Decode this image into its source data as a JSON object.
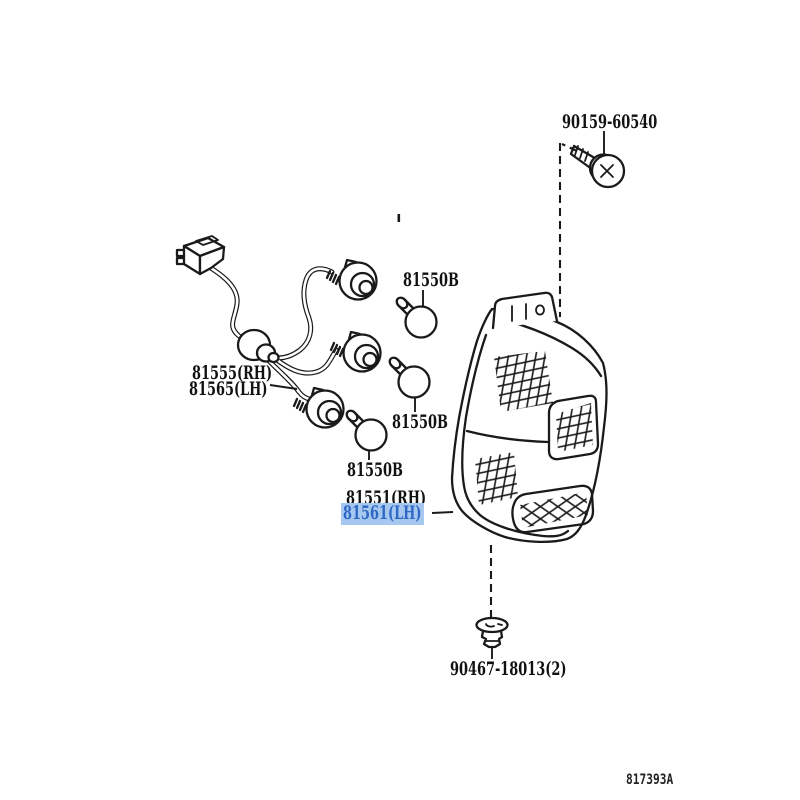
{
  "figure": {
    "code": "817393A"
  },
  "colors": {
    "line": "#1a1a1a",
    "background": "#ffffff",
    "highlight_bg": "#a6c8f0",
    "highlight_text": "#2f68c4"
  },
  "labels": {
    "screw": "90159-60540",
    "harness_rh": "81555(RH)",
    "harness_lh": "81565(LH)",
    "bulb_top": "81550B",
    "bulb_middle": "81550B",
    "bulb_bottom": "81550B",
    "lens_rh": "81551(RH)",
    "lens_lh": "81561(LH)",
    "clip": "90467-18013(2)"
  },
  "highlighted_part": "81561(LH)",
  "drawings": {
    "screw": "tapping-screw",
    "harness": "rear-lamp-wire-harness-with-sockets",
    "bulbs": "signal-bulb",
    "lens": "rear-combination-lamp-lens-and-body",
    "clip": "push-in-clip"
  }
}
